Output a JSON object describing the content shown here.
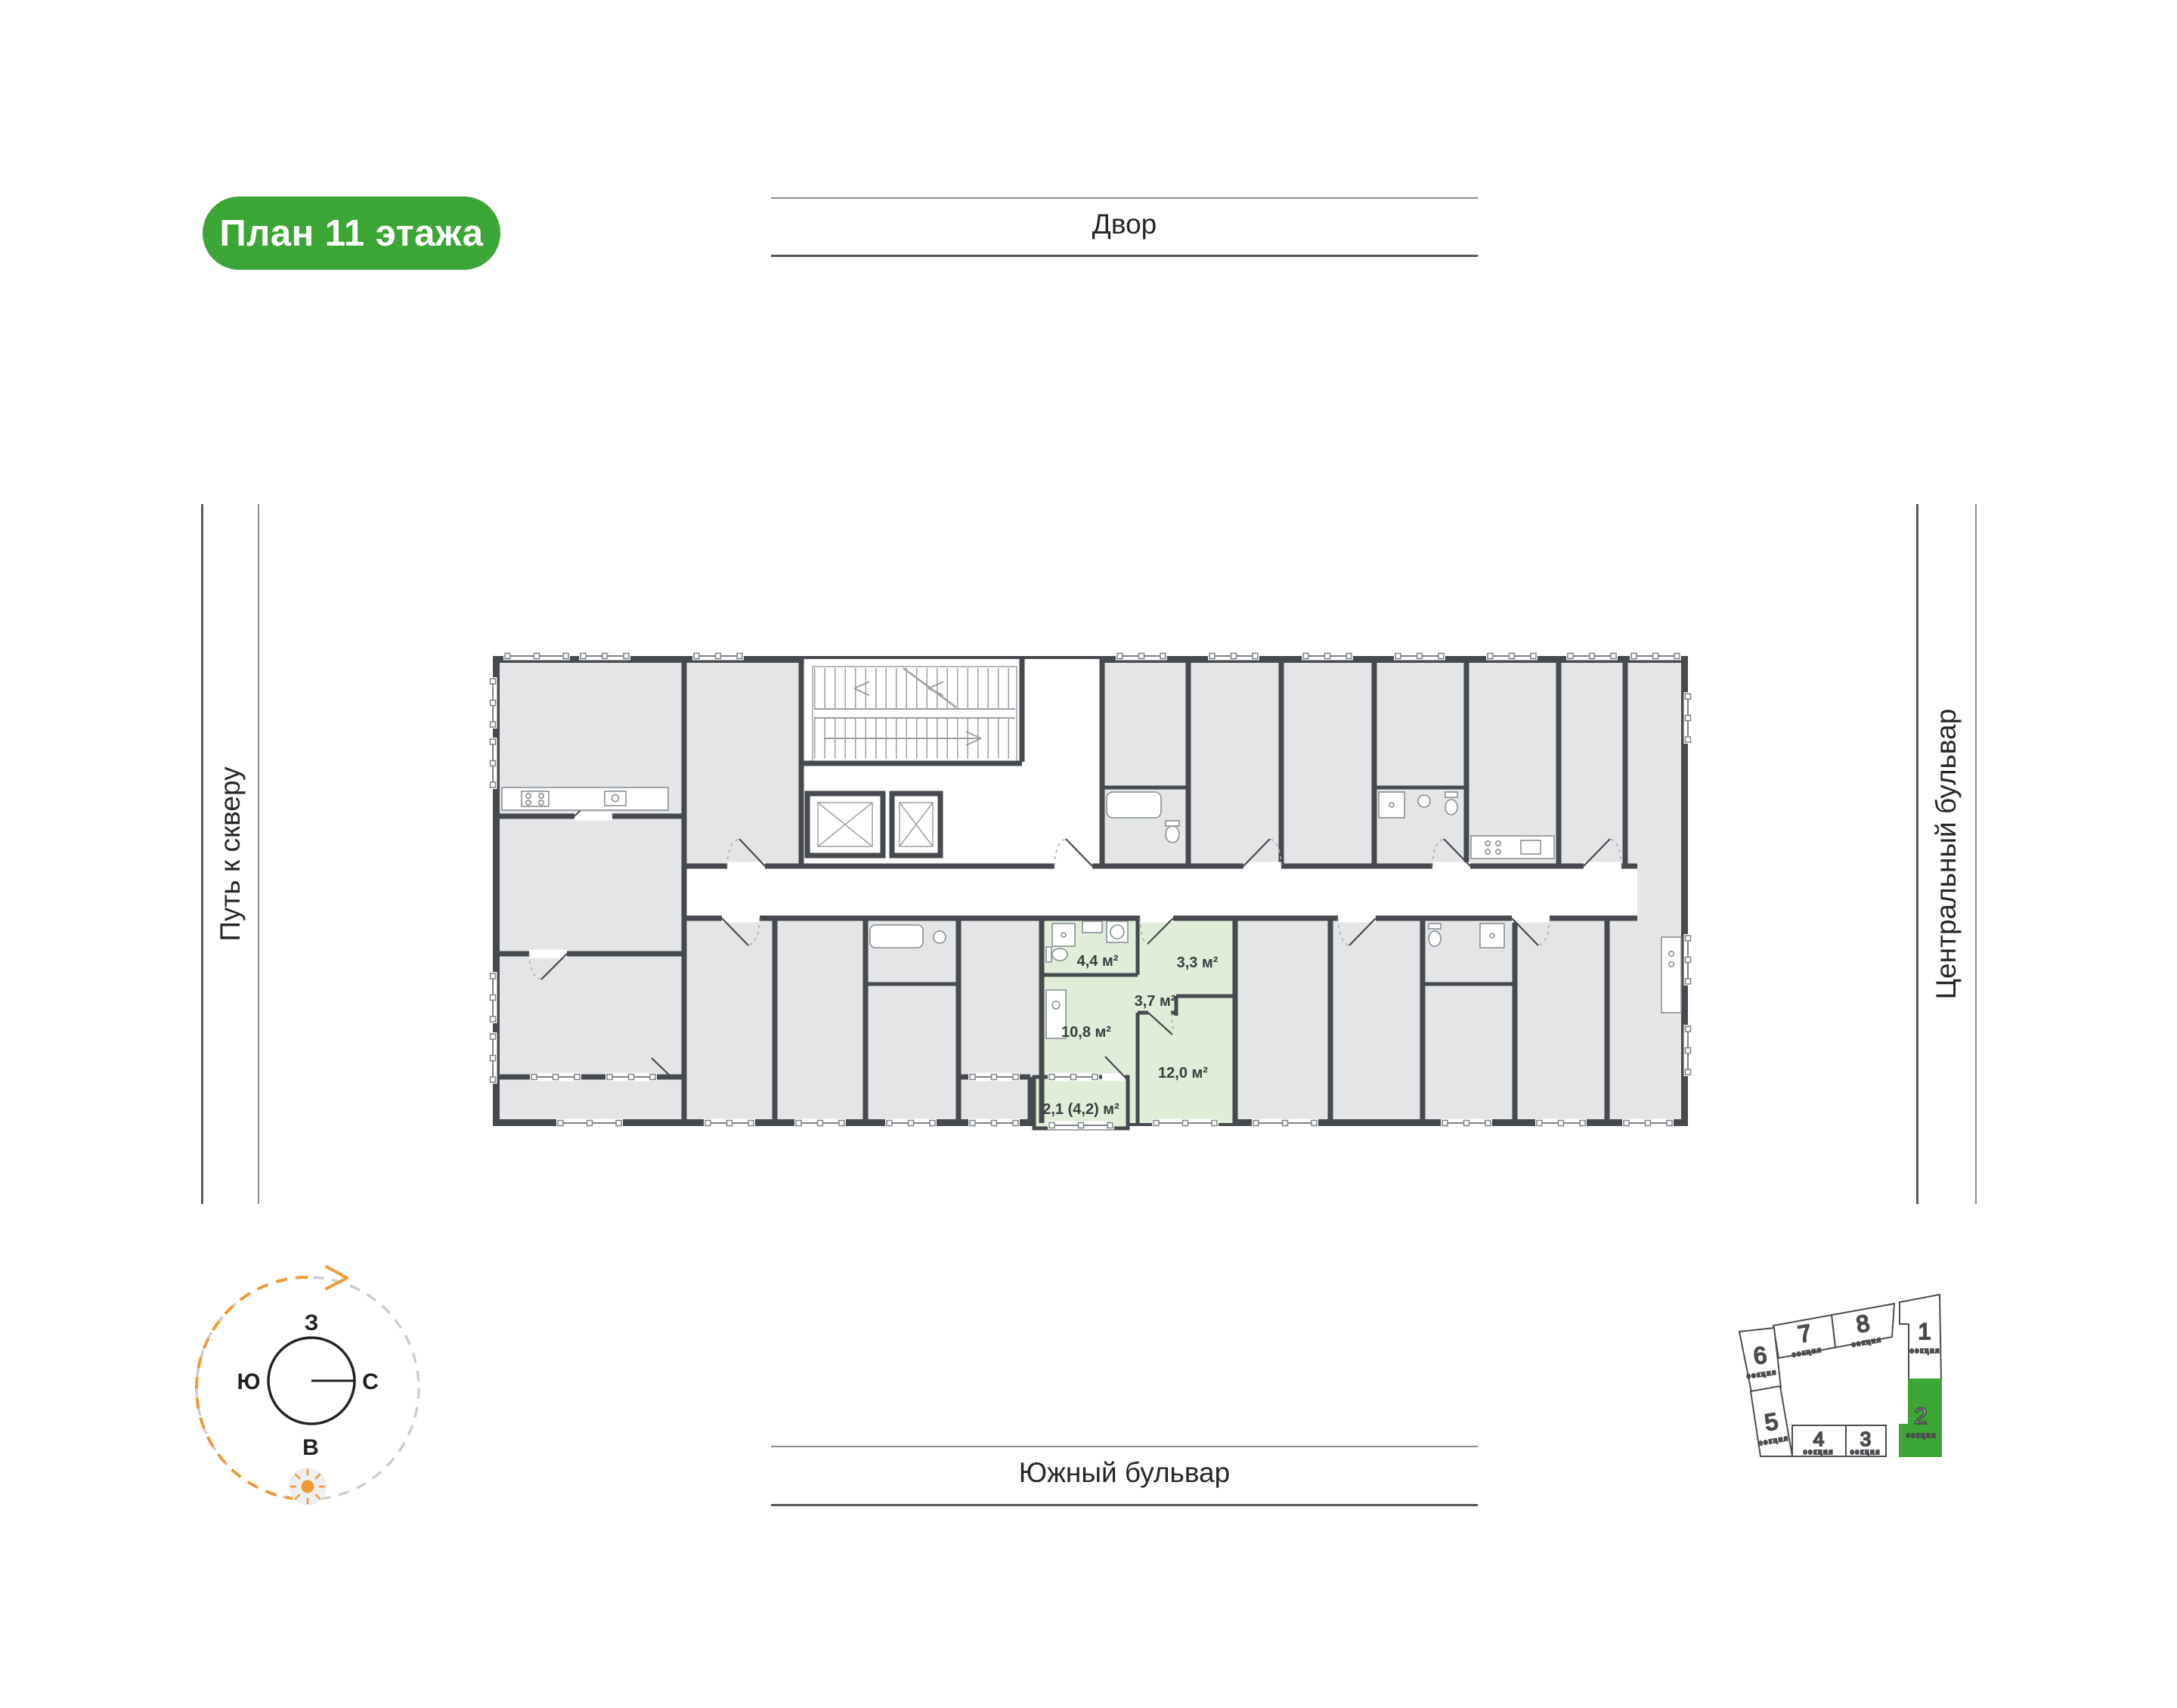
{
  "badge": {
    "label": "План 11 этажа"
  },
  "streets": {
    "top": "Двор",
    "bottom": "Южный бульвар",
    "left": "Путь к скверу",
    "right": "Центральный бульвар"
  },
  "compass": {
    "letters": {
      "top": "З",
      "right": "С",
      "bottom": "В",
      "left": "Ю"
    }
  },
  "apartment": {
    "rooms": [
      "4,4 м²",
      "3,3 м²",
      "3,7 м²",
      "10,8 м²",
      "12,0 м²",
      "2,1 (4,2) м²"
    ]
  },
  "section_map": {
    "label": "секция",
    "active_section": "2",
    "sections": [
      "1",
      "2",
      "3",
      "4",
      "5",
      "6",
      "7",
      "8"
    ]
  },
  "colors": {
    "accent_green": "#3BA636",
    "apartment_fill": "#DFEDD9",
    "wall": "#46494D",
    "compass_orange": "#F09A33"
  }
}
